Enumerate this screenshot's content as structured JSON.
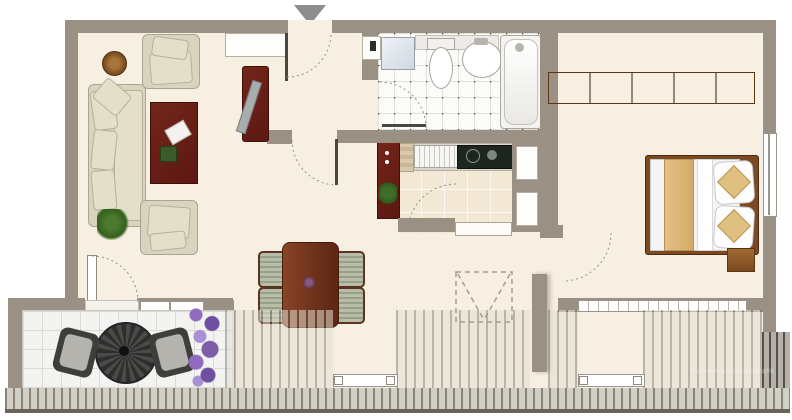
{
  "title": "apartment-floor-plan",
  "watermark": {
    "text": "mustermann@infografik"
  },
  "entrance": {
    "marker": "down-triangle"
  },
  "colors": {
    "wall": "#9a9184",
    "floor": "#f7efe1",
    "tile_bath": "#fbfbf9",
    "tile_kitchen": "#f2e8d4",
    "tile_terrace": "#f3f3f1",
    "wood": "#8a5a2b",
    "redwood": "#6d1f16",
    "fabric": "#d8d4bf",
    "cooktop": "#1e2620",
    "lavender": "#7b5ea7",
    "fence": "#d2cfc6",
    "arc": "#97918a"
  },
  "rooms": [
    {
      "name": "living-room",
      "features": [
        "corner-sofa",
        "armchair-top",
        "armchair-bottom",
        "coffee-table",
        "side-table",
        "plant",
        "sideboard"
      ]
    },
    {
      "name": "entry-hall",
      "features": [
        "entrance-door",
        "wall-niche"
      ]
    },
    {
      "name": "bathroom",
      "features": [
        "washing-machine",
        "toilet",
        "sink",
        "bathtub",
        "shelf"
      ]
    },
    {
      "name": "kitchen",
      "features": [
        "sink-counter",
        "cooktop",
        "tall-cabinet",
        "pantry-strip",
        "wall-niches"
      ]
    },
    {
      "name": "bedroom",
      "features": [
        "wardrobe",
        "double-bed",
        "pillows",
        "nightstand",
        "window"
      ]
    },
    {
      "name": "dining-area",
      "features": [
        "dining-table",
        "four-chairs",
        "roof-window-marker"
      ]
    },
    {
      "name": "terrace",
      "features": [
        "round-table",
        "two-chairs",
        "lavender-planter"
      ]
    },
    {
      "name": "balcony",
      "features": [
        "railing-sections",
        "fence",
        "gate-bars"
      ]
    }
  ]
}
